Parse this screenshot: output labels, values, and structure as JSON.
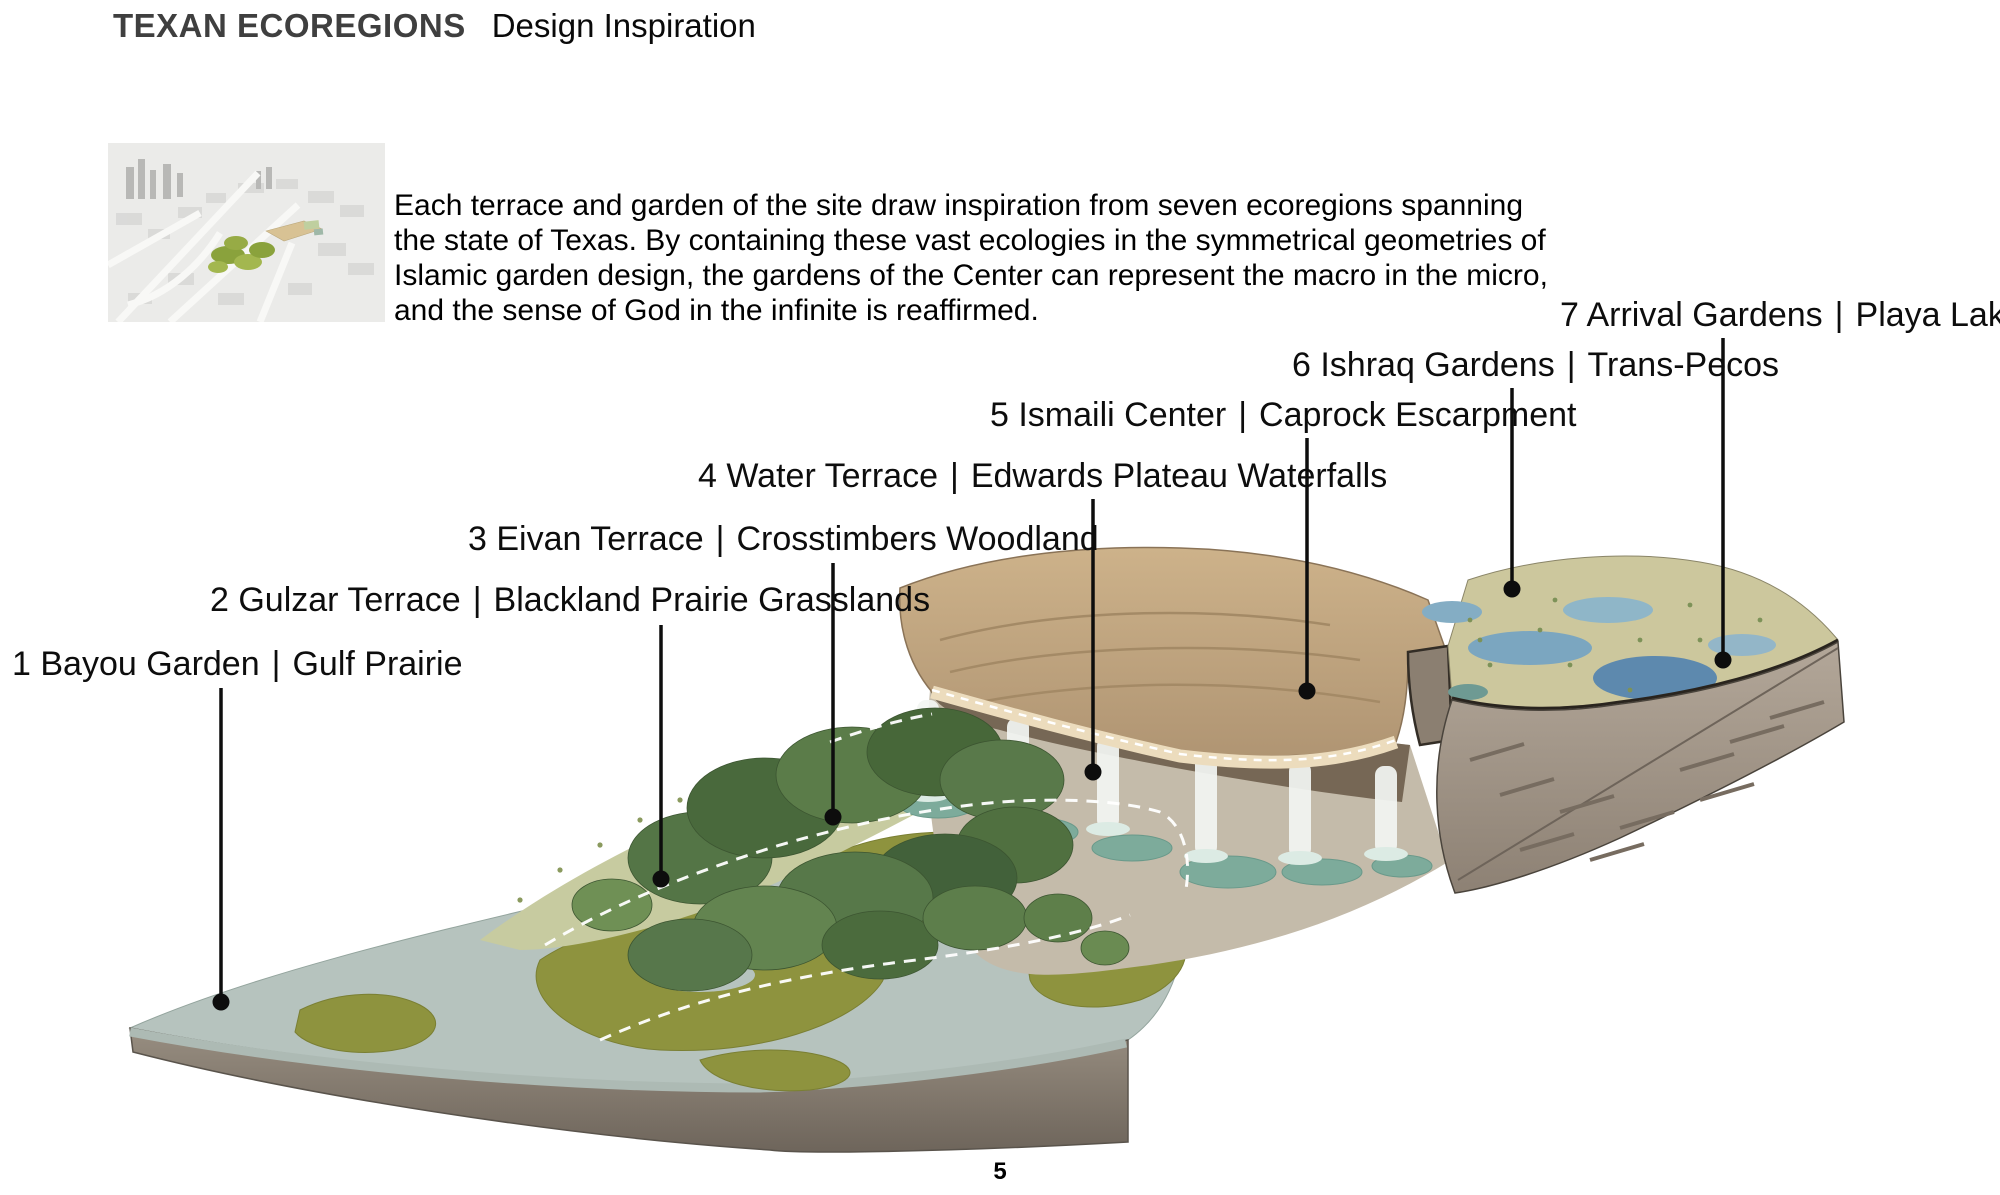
{
  "header": {
    "title": "TEXAN ECOREGIONS",
    "subtitle": "Design Inspiration"
  },
  "intro": {
    "text": "Each terrace and garden of the site draw inspiration from seven ecoregions spanning the state of Texas. By containing these vast ecologies in the symmetrical geometries of Islamic garden design, the gardens of the Center can represent the macro in the micro, and the sense of God in the infinite is reaffirmed."
  },
  "callouts": [
    {
      "number": "1",
      "garden": "Bayou Garden",
      "ecoregion": "Gulf Prairie"
    },
    {
      "number": "2",
      "garden": "Gulzar Terrace",
      "ecoregion": "Blackland Prairie Grasslands"
    },
    {
      "number": "3",
      "garden": "Eivan Terrace",
      "ecoregion": "Crosstimbers Woodland"
    },
    {
      "number": "4",
      "garden": "Water Terrace",
      "ecoregion": "Edwards Plateau Waterfalls"
    },
    {
      "number": "5",
      "garden": "Ismaili Center",
      "ecoregion": "Caprock Escarpment"
    },
    {
      "number": "6",
      "garden": "Ishraq Gardens",
      "ecoregion": "Trans-Pecos"
    },
    {
      "number": "7",
      "garden": "Arrival Gardens",
      "ecoregion": "Playa Lakes"
    }
  ],
  "separator": "|",
  "footer": {
    "page_number": "5"
  },
  "colors": {
    "title_gray": "#3f3f3f",
    "text_black": "#0d0d0d",
    "leader_line": "#0d0d0d",
    "gulf_water": "#b6c3be",
    "marsh_grass": "#8e933e",
    "soil_face": "#8a8076",
    "blackland_grass": "#c7cba0",
    "woodland_green": "#547546",
    "limestone": "#c4bbaa",
    "pool_teal": "#7dab9b",
    "waterfall_white": "#f2f5f2",
    "caprock_tan": "#c0a67f",
    "playa_sage": "#ccc79d",
    "lake_blue": "#5d89ae",
    "cliff_rock": "#a3978a"
  }
}
